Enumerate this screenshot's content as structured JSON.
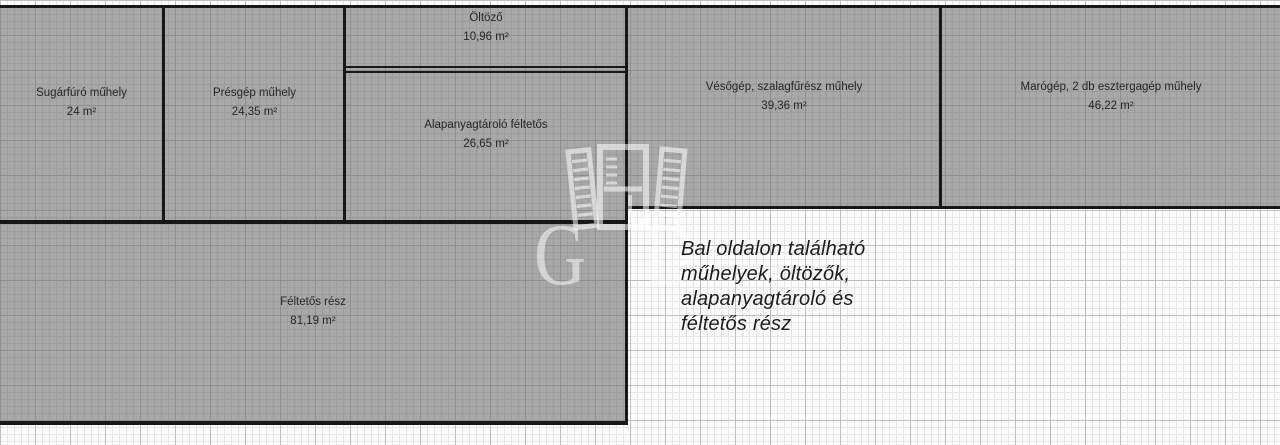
{
  "floor_plan": {
    "rooms": [
      {
        "name": "Sugárfúró műhely",
        "area": "24 m²"
      },
      {
        "name": "Présgép műhely",
        "area": "24,35 m²"
      },
      {
        "name": "Öltöző",
        "area": "10,96 m²"
      },
      {
        "name": "Alapanyagtároló féltetős",
        "area": "26,65 m²"
      },
      {
        "name": "Vésőgép, szalagfűrész műhely",
        "area": "39,36 m²"
      },
      {
        "name": "Marógép, 2 db esztergagép műhely",
        "area": "46,22 m²"
      },
      {
        "name": "Féltetős rész",
        "area": "81,19 m²"
      }
    ],
    "annotation": {
      "lines": [
        "Bal oldalon található",
        "műhelyek, öltözők,",
        "alapanyagtároló és",
        "féltetős rész"
      ]
    },
    "watermark": {
      "letters": "G D"
    },
    "colors": {
      "room_fill": "#a8a8a8",
      "wall": "#171717",
      "label_text": "#262626",
      "annotation_text": "#1d1d1d"
    }
  }
}
